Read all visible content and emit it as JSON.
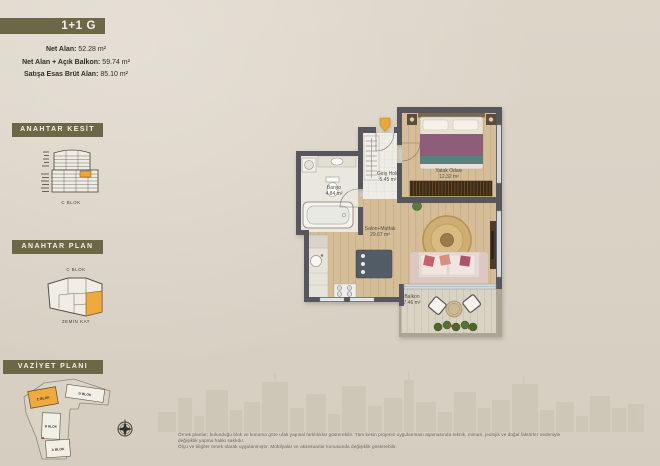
{
  "page": {
    "accent_olive": "#6c6847",
    "accent_orange": "#efa636",
    "paper": "#dad3c6"
  },
  "unit": {
    "title": "1+1 G",
    "stats": [
      {
        "label": "Net Alan:",
        "value": "52.28 m²"
      },
      {
        "label": "Net Alan + Açık Balkon:",
        "value": "59.74 m²"
      },
      {
        "label": "Satışa Esas Brüt Alan:",
        "value": "85.10 m²"
      }
    ]
  },
  "key_section": {
    "title": "ANAHTAR KESİT",
    "caption": "C BLOK"
  },
  "key_plan": {
    "title": "ANAHTAR PLAN",
    "block_label": "C BLOK",
    "caption": "ZEMİN KAT"
  },
  "site_plan": {
    "title": "VAZİYET PLANI",
    "blocks": [
      {
        "name": "C BLOK",
        "highlighted": true
      },
      {
        "name": "D BLOK",
        "highlighted": false
      },
      {
        "name": "B BLOK",
        "highlighted": false
      },
      {
        "name": "A BLOK",
        "highlighted": false
      }
    ]
  },
  "floor_plan": {
    "rooms": [
      {
        "name": "Giriş Holü",
        "area": "5.45 m²"
      },
      {
        "name": "Banyo",
        "area": "4.84 m²"
      },
      {
        "name": "Yatak Odası",
        "area": "12.32 m²"
      },
      {
        "name": "Salon+Mutfak",
        "area": "29.67 m²"
      },
      {
        "name": "Balkon",
        "area": "7.46 m²"
      }
    ]
  },
  "disclaimer": {
    "line1": "Örnek planlar; bulunduğu blok ve konuma göre ufak yapısal farklılıklar gösterebilir. Tüm kesin projenin uygulanması aşamasında teknik, mimari, jeolojik ve doğal faktörler nedeniyle değişiklik yapma hakkı saklıdır.",
    "line2": "Ölçü ve bilgiler örnek olarak uygulanmıştır. Mobilyalar ve aksesuarlar konusunda değişiklik gösterebilir."
  }
}
